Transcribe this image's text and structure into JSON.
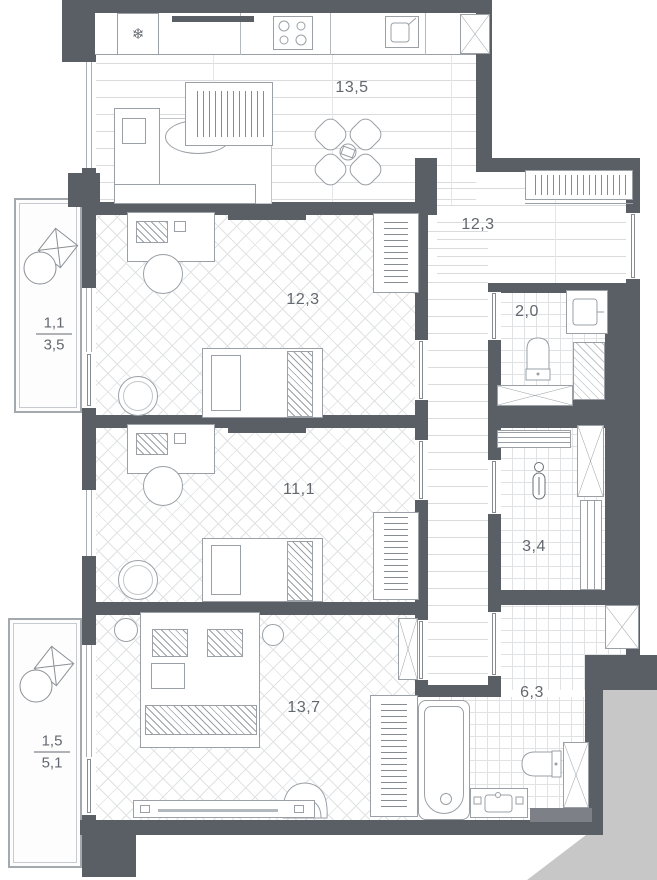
{
  "rooms": [
    {
      "id": "kitchen-living-room",
      "area": "13,5"
    },
    {
      "id": "hallway",
      "area": "12,3"
    },
    {
      "id": "bedroom-1",
      "area": "12,3"
    },
    {
      "id": "wc",
      "area": "2,0"
    },
    {
      "id": "bedroom-2",
      "area": "11,1"
    },
    {
      "id": "bathroom",
      "area": "3,4"
    },
    {
      "id": "bedroom-3",
      "area": "13,7"
    },
    {
      "id": "shower-room",
      "area": "6,3"
    }
  ],
  "balconies": [
    {
      "id": "balcony-upper",
      "over": "1,1",
      "under": "3,5"
    },
    {
      "id": "balcony-lower",
      "over": "1,5",
      "under": "5,1"
    }
  ],
  "icons": {
    "refrigerator_glyph": "❄"
  },
  "colors": {
    "wall": "#5a5f66",
    "furniture_line": "#9aa0a6",
    "floor_line": "#d9dbdd",
    "label_text": "#63686e",
    "exterior_mask": "#c7c7c7"
  }
}
